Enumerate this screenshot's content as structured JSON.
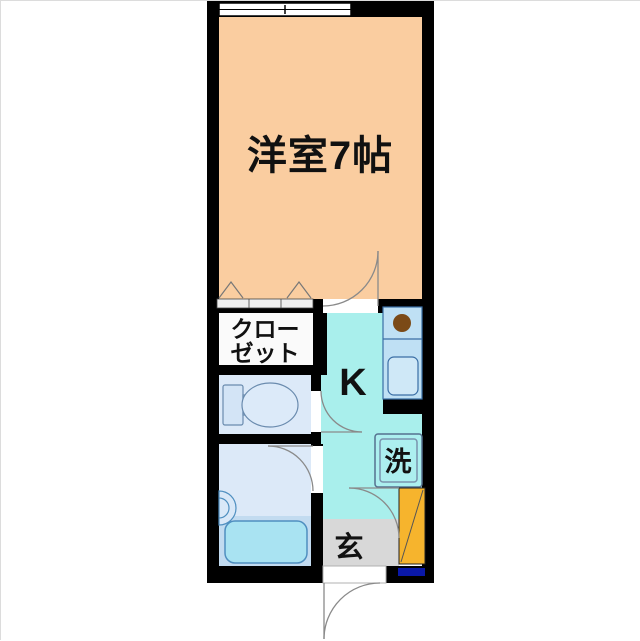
{
  "plan": {
    "rooms": {
      "main_room": "洋室7帖",
      "closet_line1": "クロー",
      "closet_line2": "ゼット",
      "kitchen": "K",
      "washer": "洗",
      "entrance": "玄"
    },
    "colors": {
      "wall": "#000000",
      "background": "#ffffff",
      "main_room_floor": "#facda0",
      "kitchen_floor": "#a9efec",
      "water_room_floor": "#dce9f8",
      "tub_area": "#c2dbf0",
      "bathtub": "#a9e3f2",
      "counter": "#bfe0f4",
      "sink": "#cfe8f7",
      "washer_box": "#acefef",
      "shoe_cabinet": "#f6b42d",
      "entrance_floor": "#d8d8d8",
      "navy_accent": "#0a18a8",
      "burner": "#7b4a17",
      "door_line": "#8a8a8a",
      "closet_floor": "#fafafa"
    }
  }
}
